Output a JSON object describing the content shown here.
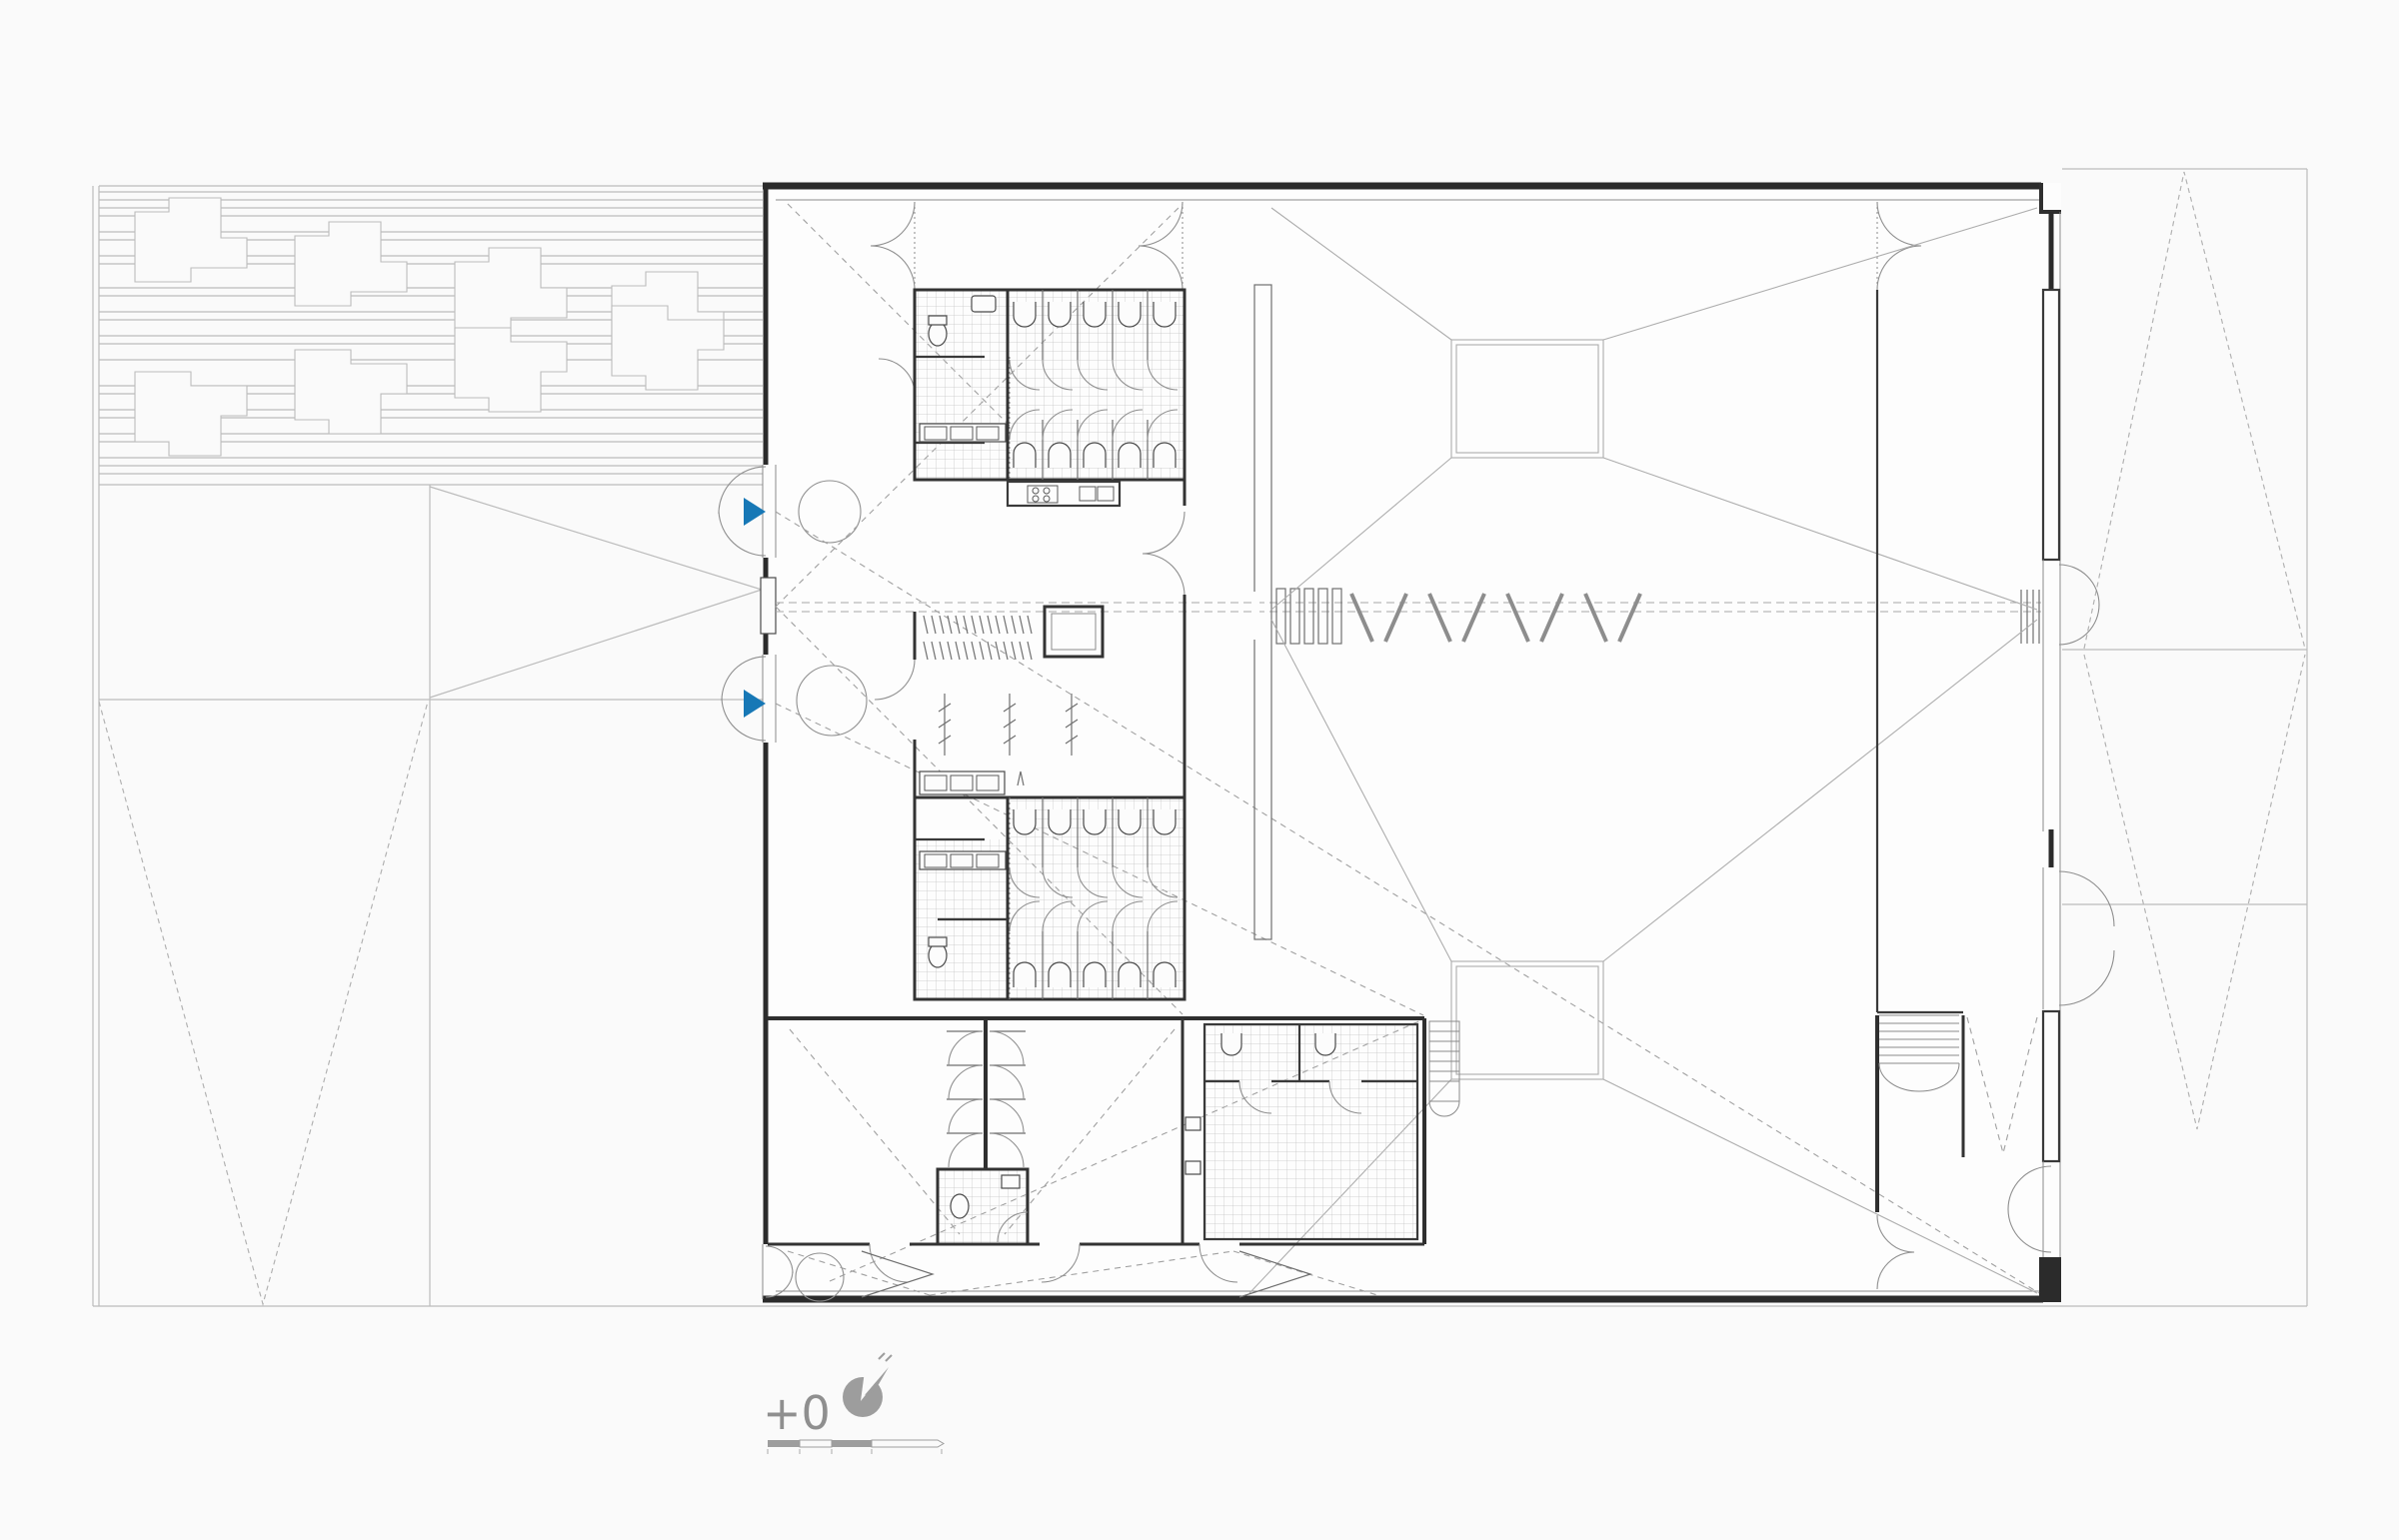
{
  "drawing": {
    "level_label": "+0"
  },
  "colors": {
    "accent_blue": "#1778b6",
    "wall_dark": "#2b2b2b",
    "site_line": "#bcbcbc",
    "detail_gray": "#8f8f8f",
    "label_gray": "#8f8f8f",
    "background": "#fafafa"
  },
  "icons": {
    "north_arrow": "north-arrow-icon",
    "entrance_marker": "entrance-marker-icon",
    "scale_bar": "scale-bar"
  },
  "markers": {
    "entrance_marker_count": 2
  },
  "scale_bar": {
    "segments": [
      {
        "filled": true
      },
      {
        "filled": false
      },
      {
        "filled": true
      },
      {
        "filled": false
      }
    ]
  }
}
